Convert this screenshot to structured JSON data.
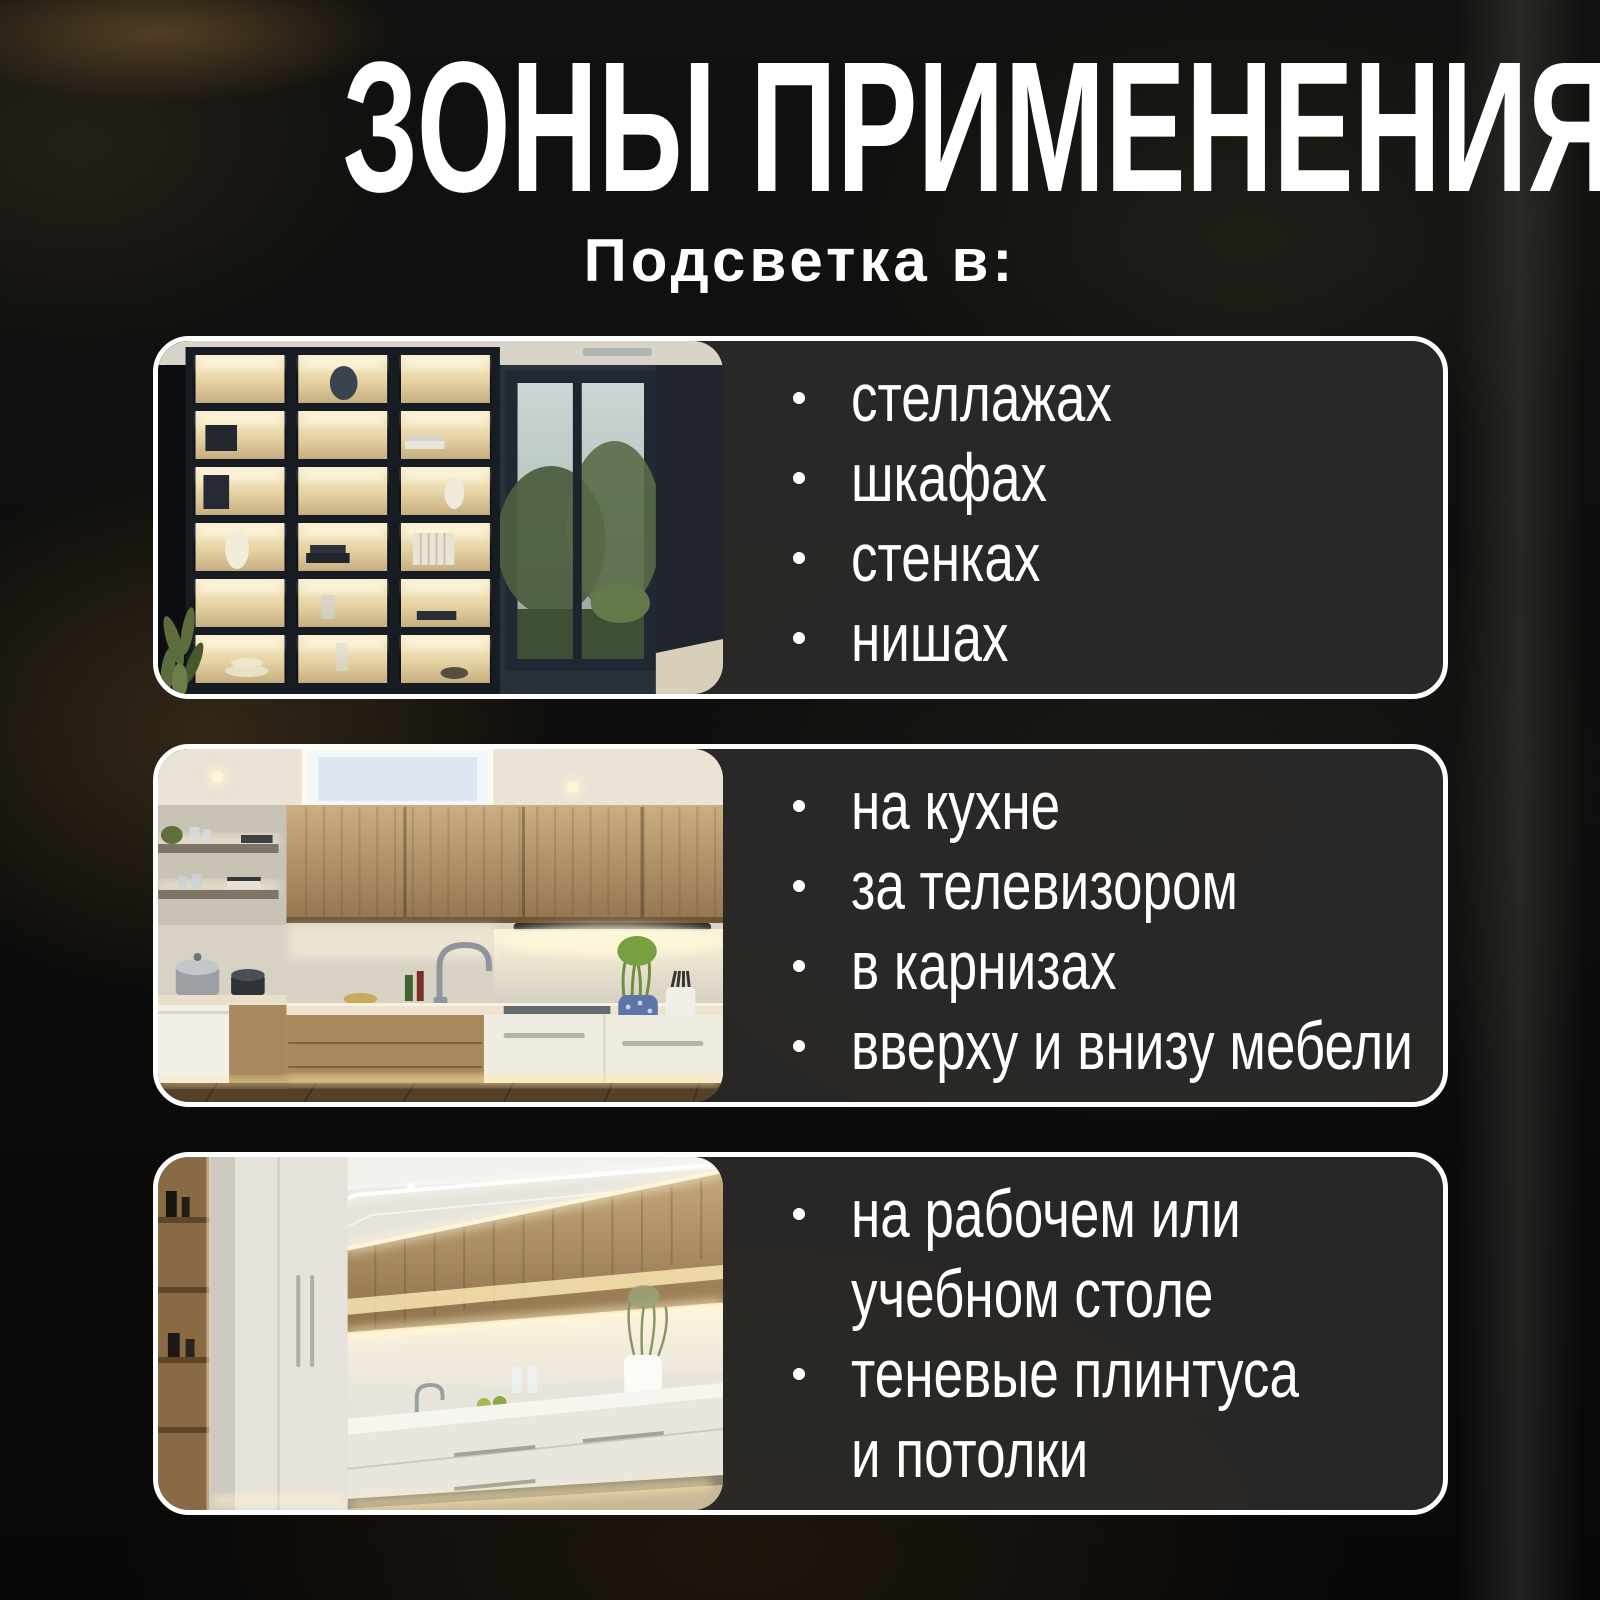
{
  "page": {
    "title": "ЗОНЫ ПРИМЕНЕНИЯ",
    "subtitle": "Подсветка в:"
  },
  "cards": [
    {
      "photo": "backlit-shelving-unit-with-window",
      "bullets": [
        "стеллажах",
        "шкафах",
        "стенках",
        "нишах"
      ]
    },
    {
      "photo": "kitchen-corner-under-cabinet-led",
      "bullets": [
        "на кухне",
        "за телевизором",
        "в карнизах",
        "вверху и внизу мебели"
      ]
    },
    {
      "photo": "galley-kitchen-led-strips",
      "bullets": [
        "на рабочем или\nучебном столе",
        "теневые плинтуса\nи потолки"
      ]
    }
  ],
  "colors": {
    "background": "#0e0d0b",
    "card_background": "#2c2a28",
    "card_border": "#ffffff",
    "text": "#ffffff",
    "led_glow": "#fff3cf"
  }
}
